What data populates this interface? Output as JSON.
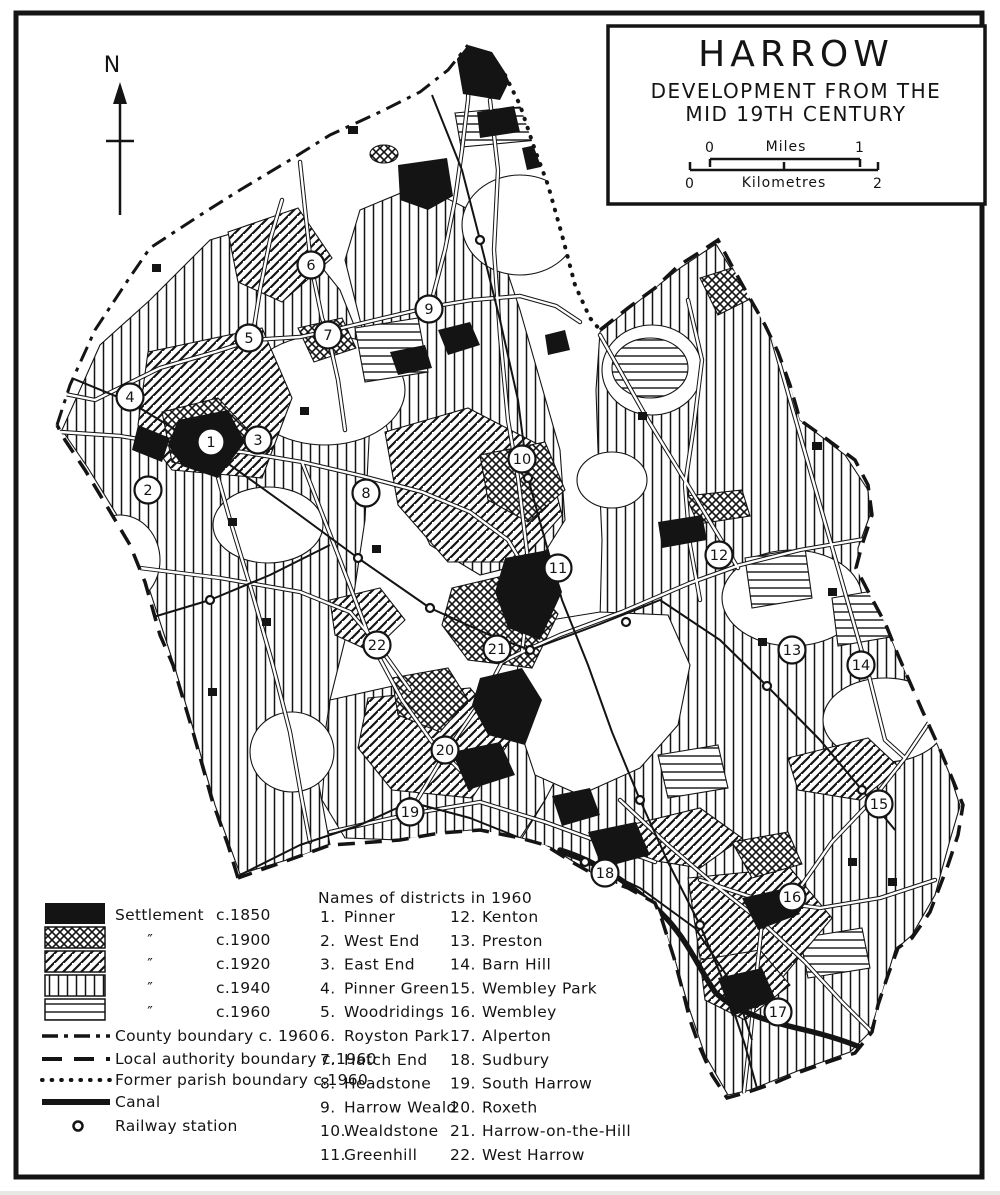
{
  "page": {
    "bg": "#ffffff",
    "ink": "#141414"
  },
  "north": {
    "label": "N"
  },
  "title_box": {
    "title": "HARROW",
    "subtitle1": "DEVELOPMENT FROM THE",
    "subtitle2": "MID 19TH CENTURY",
    "miles_scale": {
      "start": "0",
      "unit": "Miles",
      "end": "1"
    },
    "km_scale": {
      "start": "0",
      "unit": "Kilometres",
      "end": "2"
    }
  },
  "legend": {
    "area_items": [
      {
        "pattern": "solid-black",
        "prefix": "Settlement",
        "label": "c.1850"
      },
      {
        "pattern": "crosshatch",
        "prefix": "″",
        "label": "c.1900"
      },
      {
        "pattern": "diagonal-hatch",
        "prefix": "″",
        "label": "c.1920"
      },
      {
        "pattern": "vertical-hatch",
        "prefix": "″",
        "label": "c.1940"
      },
      {
        "pattern": "horizontal-hatch",
        "prefix": "″",
        "label": "c.1960"
      }
    ],
    "line_items": [
      {
        "style": "dashdot",
        "label": "County boundary c. 1960"
      },
      {
        "style": "dashed",
        "label": "Local authority boundary c.1960"
      },
      {
        "style": "dotted",
        "label": "Former parish boundary c.1960"
      },
      {
        "style": "solid-thick",
        "label": "Canal"
      }
    ],
    "symbol_items": [
      {
        "symbol": "station-circle",
        "label": "Railway station"
      }
    ]
  },
  "districts": {
    "heading": "Names of districts in 1960",
    "column1": [
      [
        "1.",
        "Pinner"
      ],
      [
        "2.",
        "West End"
      ],
      [
        "3.",
        "East End"
      ],
      [
        "4.",
        "Pinner Green"
      ],
      [
        "5.",
        "Woodridings"
      ],
      [
        "6.",
        "Royston Park"
      ],
      [
        "7.",
        "Hatch End"
      ],
      [
        "8.",
        "Headstone"
      ],
      [
        "9.",
        "Harrow Weald"
      ],
      [
        "10.",
        "Wealdstone"
      ],
      [
        "11.",
        "Greenhill"
      ]
    ],
    "column2": [
      [
        "12.",
        "Kenton"
      ],
      [
        "13.",
        "Preston"
      ],
      [
        "14.",
        "Barn Hill"
      ],
      [
        "15.",
        "Wembley Park"
      ],
      [
        "16.",
        "Wembley"
      ],
      [
        "17.",
        "Alperton"
      ],
      [
        "18.",
        "Sudbury"
      ],
      [
        "19.",
        "South Harrow"
      ],
      [
        "20.",
        "Roxeth"
      ],
      [
        "21.",
        "Harrow-on-the-Hill"
      ],
      [
        "22.",
        "West Harrow"
      ]
    ]
  },
  "map": {
    "markers": [
      {
        "n": "1",
        "x": 211,
        "y": 442
      },
      {
        "n": "2",
        "x": 148,
        "y": 490
      },
      {
        "n": "3",
        "x": 258,
        "y": 440
      },
      {
        "n": "4",
        "x": 130,
        "y": 397
      },
      {
        "n": "5",
        "x": 249,
        "y": 338
      },
      {
        "n": "6",
        "x": 311,
        "y": 265
      },
      {
        "n": "7",
        "x": 328,
        "y": 335
      },
      {
        "n": "8",
        "x": 366,
        "y": 493
      },
      {
        "n": "9",
        "x": 429,
        "y": 309
      },
      {
        "n": "10",
        "x": 522,
        "y": 459
      },
      {
        "n": "11",
        "x": 558,
        "y": 568
      },
      {
        "n": "12",
        "x": 719,
        "y": 555
      },
      {
        "n": "13",
        "x": 792,
        "y": 650
      },
      {
        "n": "14",
        "x": 861,
        "y": 665
      },
      {
        "n": "15",
        "x": 879,
        "y": 804
      },
      {
        "n": "16",
        "x": 792,
        "y": 897
      },
      {
        "n": "17",
        "x": 778,
        "y": 1012
      },
      {
        "n": "18",
        "x": 605,
        "y": 873
      },
      {
        "n": "19",
        "x": 410,
        "y": 812
      },
      {
        "n": "20",
        "x": 445,
        "y": 750
      },
      {
        "n": "21",
        "x": 497,
        "y": 649
      },
      {
        "n": "22",
        "x": 377,
        "y": 645
      }
    ],
    "stations": [
      {
        "x": 212,
        "y": 452
      },
      {
        "x": 358,
        "y": 558
      },
      {
        "x": 430,
        "y": 608
      },
      {
        "x": 530,
        "y": 650
      },
      {
        "x": 626,
        "y": 622
      },
      {
        "x": 767,
        "y": 686
      },
      {
        "x": 862,
        "y": 790
      },
      {
        "x": 480,
        "y": 240
      },
      {
        "x": 528,
        "y": 478
      },
      {
        "x": 640,
        "y": 800
      },
      {
        "x": 700,
        "y": 925
      },
      {
        "x": 410,
        "y": 802
      },
      {
        "x": 585,
        "y": 862
      },
      {
        "x": 210,
        "y": 600
      }
    ]
  }
}
